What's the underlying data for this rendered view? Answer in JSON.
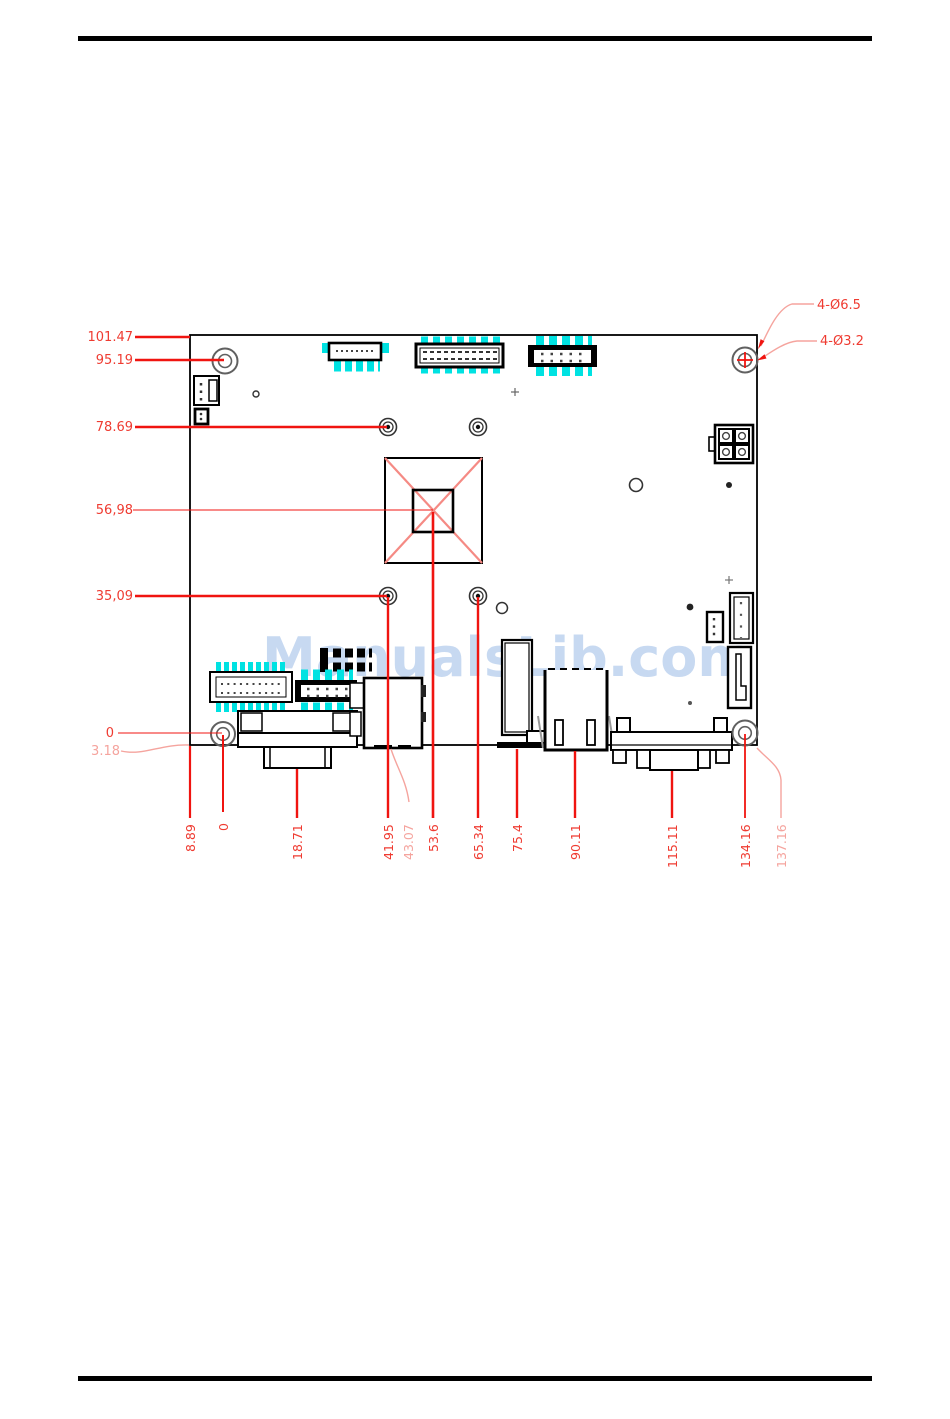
{
  "watermark": {
    "text": "ManualsLib.com"
  },
  "dimensions": {
    "left": [
      "101.47",
      "95.19",
      "78.69",
      "56,98",
      "35,09",
      "0",
      "3.18"
    ],
    "right": [
      "4-Ø6.5",
      "4-Ø3.2"
    ],
    "bottom": [
      "8.89",
      "0",
      "18.71",
      "41.95",
      "43.07",
      "53.6",
      "65.34",
      "75.4",
      "90.11",
      "115.11",
      "134.16",
      "137.16"
    ]
  },
  "colors": {
    "dimension_red": "#f01410",
    "dimension_text_red": "#ef3b31",
    "dimension_light_red": "#f5a49e",
    "pad_cyan": "#00e2e2",
    "watermark_blue": "#c7d9f1",
    "outline_black": "#000000"
  },
  "icons": {
    "cpu_cross": "diagonal-cross-marker",
    "hole_cross": "center-cross-marker"
  }
}
